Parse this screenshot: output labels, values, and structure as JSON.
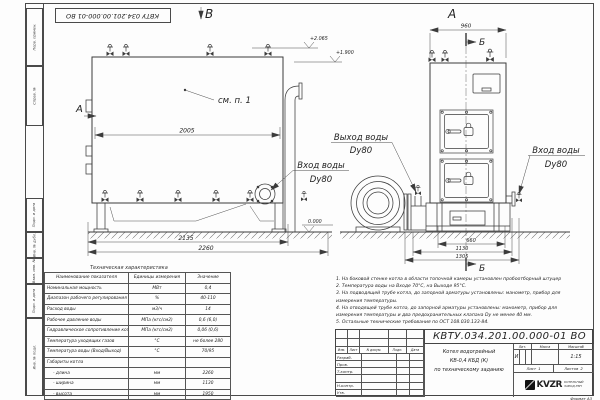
{
  "frame": {
    "stamp_top": "КВТУ 034.201.00.000-01 ВО",
    "side_labels": [
      "Перв. примен.",
      "Справ. №",
      "Подп. и дата",
      "Инв. № дубл.",
      "Взам. инв. №",
      "Подп. и дата",
      "Инв. № подл."
    ],
    "format_note": "Формат А3"
  },
  "views": {
    "front_title": "А",
    "side_title": "В",
    "section_mark": "Б",
    "cut_mark_left": "А",
    "see_item": "см. п. 1"
  },
  "dimensions": {
    "side_width_inner": "2005",
    "side_width_base": "2135",
    "side_width_overall": "2260",
    "front_width_top": "960",
    "front_dim_1": "660",
    "front_dim_2": "1130",
    "front_dim_3": "1305"
  },
  "elevations": {
    "mark_1": "+2.065",
    "mark_2": "+1.900",
    "mark_zero": "0.000"
  },
  "pipe_labels": {
    "outlet_title": "Выход воды",
    "outlet_size": "Dy80",
    "inlet_side_title": "Вход воды",
    "inlet_side_size": "Dy80",
    "inlet_front_title": "Вход воды",
    "inlet_front_size": "Dy80"
  },
  "spec_table": {
    "title": "Техническая характеристика",
    "headers": [
      "Наименование показателя",
      "Единицы измерения",
      "Значение"
    ],
    "rows": [
      {
        "name": "Номинальная мощность",
        "unit": "МВт",
        "value": "0,4"
      },
      {
        "name": "Диапазон рабочего регулирования",
        "unit": "%",
        "value": "40-110"
      },
      {
        "name": "Расход воды",
        "unit": "м3/ч",
        "value": "14"
      },
      {
        "name": "Рабочее давление воды",
        "unit": "МПа (кгс/см2)",
        "value": "0,6 (6,0)"
      },
      {
        "name": "Гидравлическое сопротивление котла",
        "unit": "МПа (кгс/см2)",
        "value": "0,06 (0,6)"
      },
      {
        "name": "Температура уходящих газов",
        "unit": "°С",
        "value": "не более 280"
      },
      {
        "name": "Температура воды (Вход/Выход)",
        "unit": "°С",
        "value": "70/95"
      },
      {
        "name": "Габариты котла",
        "unit": "",
        "value": ""
      },
      {
        "name": "- длина",
        "unit": "мм",
        "value": "2260"
      },
      {
        "name": "- ширина",
        "unit": "мм",
        "value": "1130"
      },
      {
        "name": "- высота",
        "unit": "мм",
        "value": "1950"
      }
    ]
  },
  "notes": {
    "lines": [
      "1.  На боковой стенке котла в области топочной камеры установлен пробоотборный штуцер",
      "2.  Температура воды на Входе 70°С, на Выходе 95°С.",
      "3.  На подводящей трубе котла, до запорной арматуры установлены: манометр, прибор для",
      "измерения температуры.",
      "4.  На отводящей трубе котла, до запорной арматуры установлены: манометр, прибор для",
      "измерения температуры и два предохранительных клапана Dy не менее 40 мм.",
      "5.  Остальные технические требования по ОСТ 108.030.133-84."
    ]
  },
  "title_block": {
    "doc_number": "КВТУ.034.201.00.000-01 ВО",
    "product_lines": [
      "Котел водогрейный",
      "КВ-0,4 КБД (К)",
      "по техническому заданию"
    ],
    "rev_headers": [
      "Изм.",
      "Лист",
      "N докум.",
      "Подп.",
      "Дата"
    ],
    "roles": [
      "Разраб.",
      "Пров.",
      "Т.контр.",
      "Н.контр.",
      "Утв."
    ],
    "lit_header": "Лит.",
    "mass_header": "Масса",
    "scale_header": "Масштаб",
    "lit_value": "И",
    "scale_value": "1:15",
    "sheet_label": "Лист",
    "sheet_value": "1",
    "sheets_label": "Листов",
    "sheets_value": "2",
    "company_logo": "KVZR",
    "company_line1": "КОТЕЛЬНЫЙ",
    "company_line2": "ЗАВОД РЭП"
  }
}
